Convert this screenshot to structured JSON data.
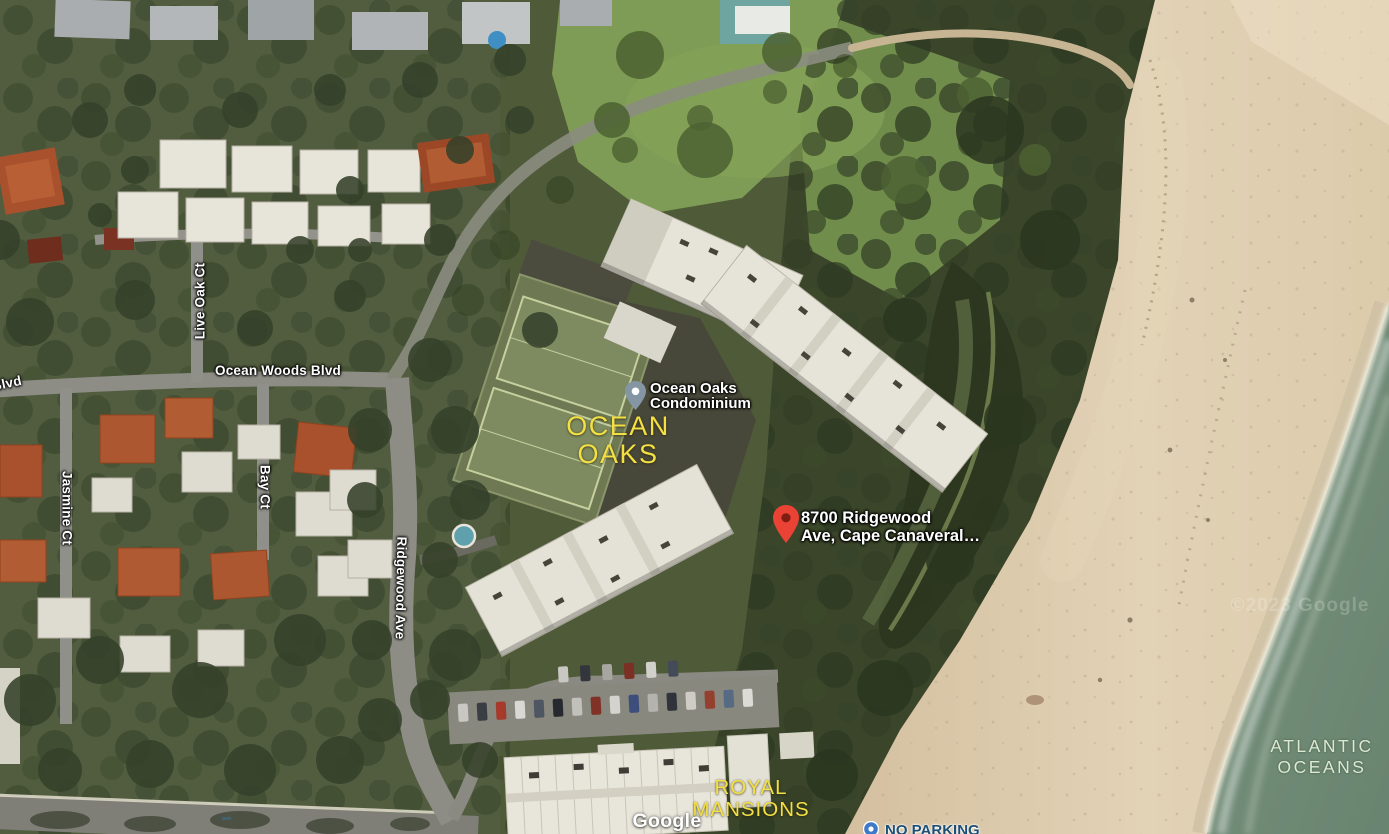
{
  "map": {
    "view_type": "satellite",
    "area_labels": {
      "ocean_oaks": {
        "line1": "OCEAN",
        "line2": "OAKS"
      },
      "royal_mansions": {
        "line1": "ROYAL",
        "line2": "MANSIONS"
      },
      "atlantic_ocean": {
        "line1": "ATLANTIC",
        "line2": "OCEANS"
      }
    },
    "pois": {
      "condo": {
        "line1": "Ocean Oaks",
        "line2": "Condominium",
        "icon": "gray-map-pin"
      },
      "address": {
        "line1": "8700 Ridgewood",
        "line2": "Ave, Cape Canaveral…",
        "icon": "red-map-pin"
      },
      "partial": {
        "text": "NO PARKING",
        "icon": "blue-poi-dot"
      }
    },
    "roads": {
      "ocean_woods_blvd": "Ocean Woods Blvd",
      "blvd_partial": "Blvd",
      "live_oak_ct": "Live Oak Ct",
      "jasmine_ct": "Jasmine Ct",
      "bay_ct": "Bay Ct",
      "ridgewood_ave": "Ridgewood Ave"
    },
    "attribution": {
      "logo": "Google",
      "watermark": "©2023 Google"
    },
    "colors": {
      "area_label_yellow": "#f2e044",
      "water_label": "#dcead2",
      "pin_red": "#ea4335",
      "pin_red_inner": "#7f1d12",
      "poi_pin_gray": "#8496a4",
      "ocean": "#74907c",
      "sand": "#dcc9ab",
      "vegetation": "#3a452a"
    }
  }
}
